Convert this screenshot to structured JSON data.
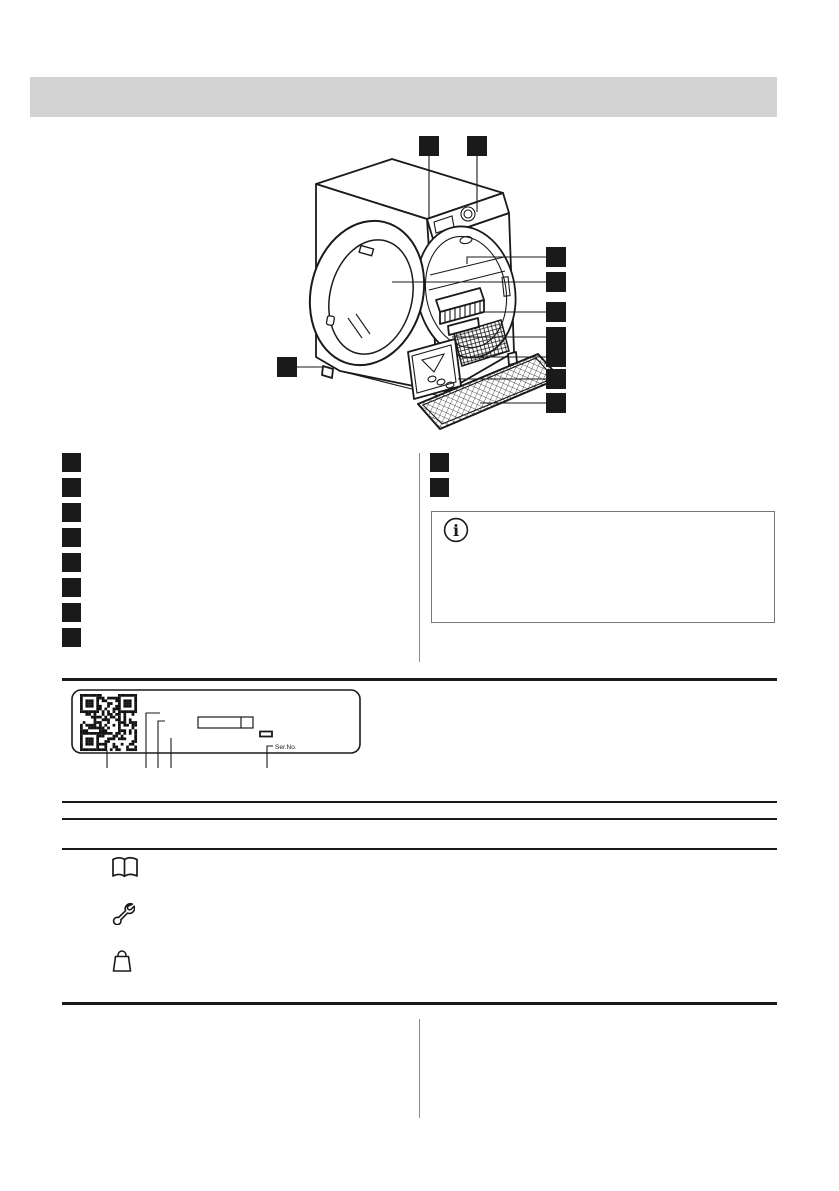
{
  "document": {
    "kind": "appliance-user-manual-page",
    "subject": "tumble-dryer-product-description"
  },
  "header": {
    "bar_text": ""
  },
  "diagram": {
    "name": "tumble-dryer-front-isometric-view",
    "callouts": [
      {
        "id": "callout-1",
        "label": ""
      },
      {
        "id": "callout-2",
        "label": ""
      },
      {
        "id": "callout-3",
        "label": ""
      },
      {
        "id": "callout-4",
        "label": ""
      },
      {
        "id": "callout-5",
        "label": ""
      },
      {
        "id": "callout-6",
        "label": ""
      },
      {
        "id": "callout-7",
        "label": ""
      },
      {
        "id": "callout-8",
        "label": ""
      },
      {
        "id": "callout-9",
        "label": ""
      },
      {
        "id": "callout-10",
        "label": ""
      }
    ]
  },
  "parts_list": {
    "left": [
      {
        "label": ""
      },
      {
        "label": ""
      },
      {
        "label": ""
      },
      {
        "label": ""
      },
      {
        "label": ""
      },
      {
        "label": ""
      },
      {
        "label": ""
      },
      {
        "label": ""
      }
    ],
    "right": [
      {
        "label": ""
      },
      {
        "label": ""
      }
    ]
  },
  "note_box": {
    "icon": "info-icon",
    "glyph": "i",
    "text": ""
  },
  "rating_plate": {
    "icon": "qr-code",
    "ser_no_label": "Ser.No.",
    "fields": [
      "model-number-box",
      "energy-strip-icon"
    ]
  },
  "resource_rows": [
    {
      "icon": "open-book-icon",
      "text": ""
    },
    {
      "icon": "wrench-icon",
      "text": ""
    },
    {
      "icon": "shopping-bag-icon",
      "text": ""
    }
  ],
  "colors": {
    "header_bar": "#d3d3d3",
    "ink": "#1a1a1a",
    "divider": "#8a8a8a",
    "qr": "#111111"
  }
}
